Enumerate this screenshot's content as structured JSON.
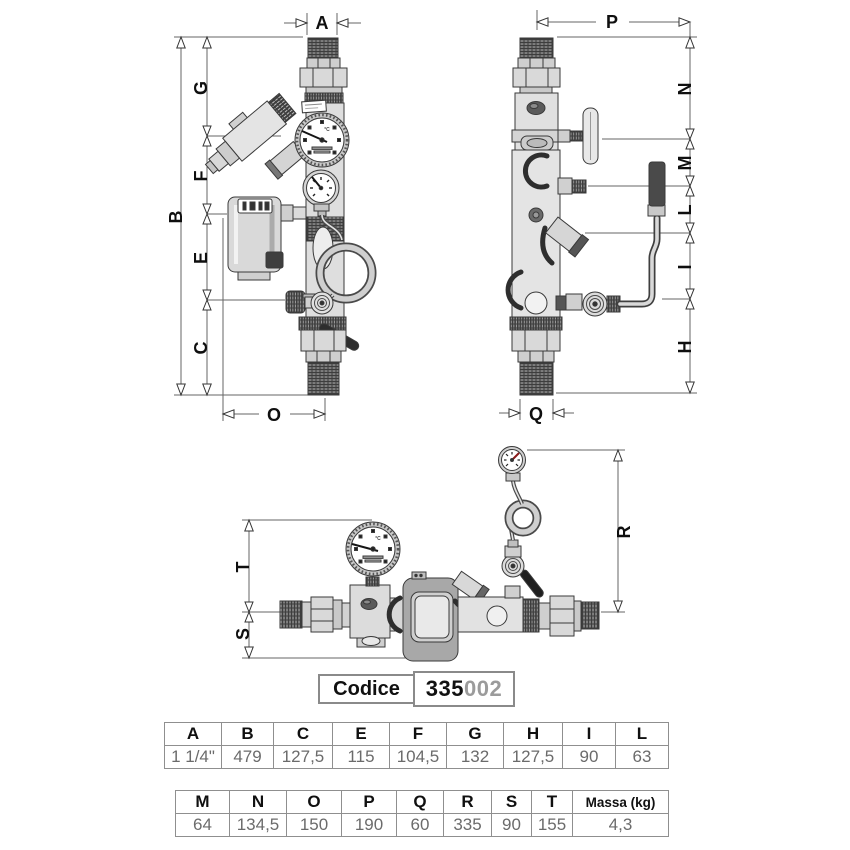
{
  "code": {
    "label": "Codice",
    "number_bold": "335",
    "number_light": "002"
  },
  "gauge_unit": "°C",
  "dim_labels": {
    "A": "A",
    "B": "B",
    "C": "C",
    "E": "E",
    "F": "F",
    "G": "G",
    "H": "H",
    "I": "I",
    "L": "L",
    "M": "M",
    "N": "N",
    "O": "O",
    "P": "P",
    "Q": "Q",
    "R": "R",
    "S": "S",
    "T": "T"
  },
  "t1": {
    "headers": [
      "A",
      "B",
      "C",
      "E",
      "F",
      "G",
      "H",
      "I",
      "L"
    ],
    "values": [
      "1 1/4\"",
      "479",
      "127,5",
      "115",
      "104,5",
      "132",
      "127,5",
      "90",
      "63"
    ]
  },
  "t2": {
    "headers": [
      "M",
      "N",
      "O",
      "P",
      "Q",
      "R",
      "S",
      "T",
      "Massa (kg)"
    ],
    "values": [
      "64",
      "134,5",
      "150",
      "190",
      "60",
      "335",
      "90",
      "155",
      "4,3"
    ]
  }
}
